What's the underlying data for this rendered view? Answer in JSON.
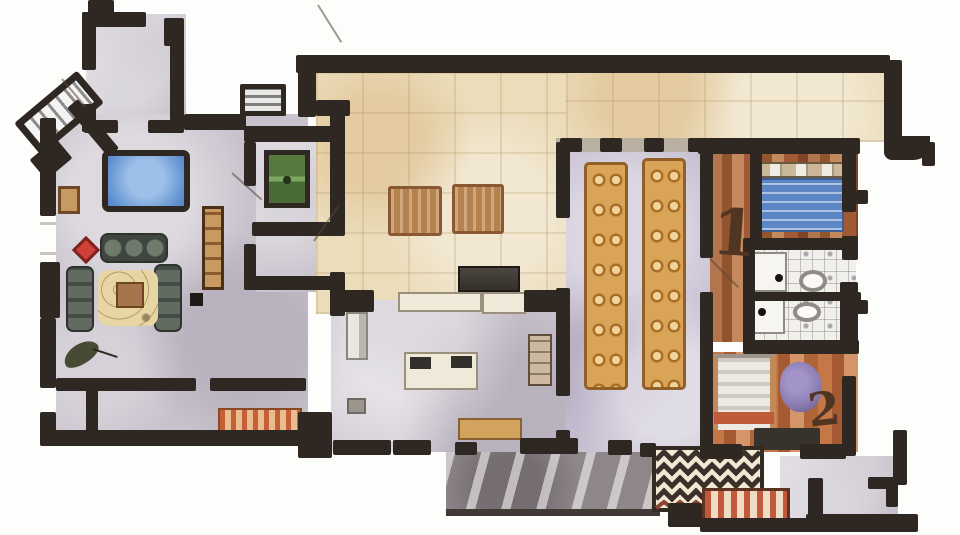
{
  "meta": {
    "title": "Hand-painted watercolor floor plan",
    "background": "#fdfdfb"
  },
  "labels": {
    "bedroom_one": "1",
    "bedroom_two": "2"
  },
  "rooms": [
    {
      "name": "entry-vestibule"
    },
    {
      "name": "living-room"
    },
    {
      "name": "games-room"
    },
    {
      "name": "storage-room"
    },
    {
      "name": "hallway"
    },
    {
      "name": "courtyard-patio"
    },
    {
      "name": "kitchen"
    },
    {
      "name": "dining-hall"
    },
    {
      "name": "bedroom-1"
    },
    {
      "name": "water-closets"
    },
    {
      "name": "bedroom-2"
    },
    {
      "name": "rear-entry"
    },
    {
      "name": "terrace"
    }
  ],
  "furniture": [
    "angled-staircase",
    "upper-staircase",
    "pool-table",
    "side-cabinet",
    "red-chair",
    "three-seat-sofa",
    "left-sofa",
    "right-sofa",
    "area-rug",
    "coffee-table",
    "potted-plant",
    "bookshelf",
    "side-table",
    "game-table",
    "floor-mat",
    "floor-mat",
    "range",
    "counter",
    "refrigerator",
    "kitchen-island",
    "cooktop",
    "pantry-shelves",
    "bench",
    "dining-table",
    "dining-table",
    "bed-blue",
    "door-leaf",
    "toilet",
    "door-leaf",
    "toilet",
    "bed-white",
    "purple-rug",
    "dresser",
    "chevron-rug",
    "striped-runner",
    "corridor-runner"
  ],
  "colors": {
    "wall": "#2f2722",
    "floor_gray": "#c8c2cc",
    "courtyard_beige": "#ebdcba",
    "dining_lavender": "#c7c0d2",
    "wood_light": "#c4895c",
    "wood_dark": "#92532f",
    "pool_table_blue": "#5d8fd0",
    "game_table_green": "#567a3d",
    "bed_blanket_blue": "#5c86c4",
    "rug_red": "#c2583c",
    "rug_purple": "#8d7fb5",
    "rug_cream": "#e8d5a4",
    "terrace_gray": "#8e8689",
    "table_tan": "#d9a458"
  }
}
